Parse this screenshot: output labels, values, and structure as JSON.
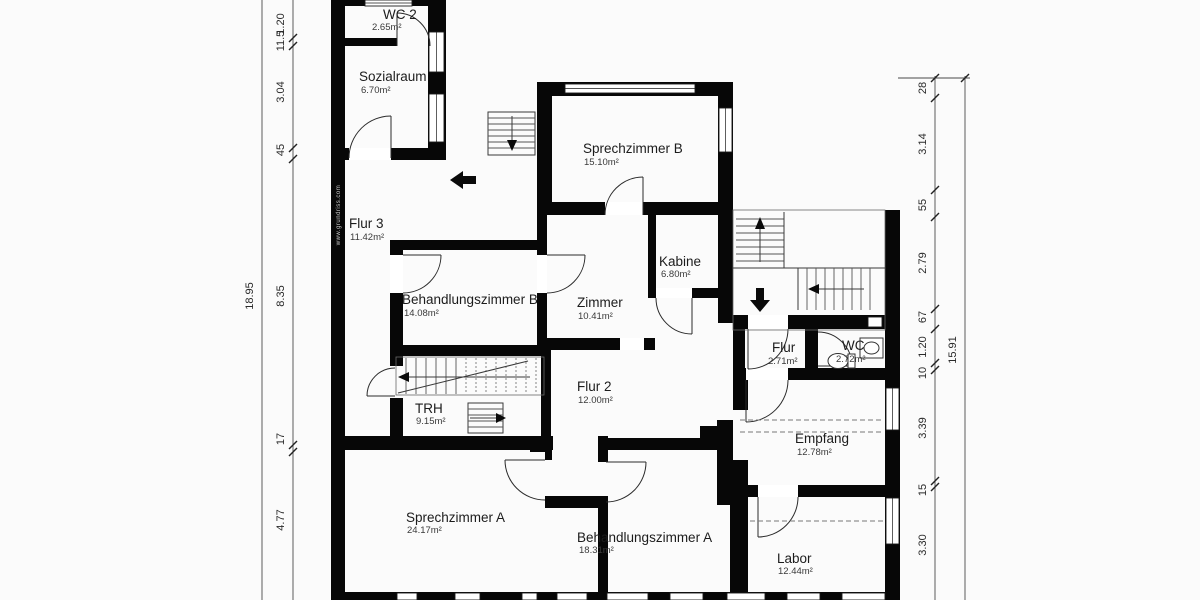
{
  "watermark": "www.grundriss.com",
  "rooms": [
    {
      "id": "wc2",
      "name": "WC 2",
      "area": "2.65m²"
    },
    {
      "id": "sozialraum",
      "name": "Sozialraum",
      "area": "6.70m²"
    },
    {
      "id": "sprechzimmer-b",
      "name": "Sprechzimmer B",
      "area": "15.10m²"
    },
    {
      "id": "flur-3",
      "name": "Flur 3",
      "area": "11.42m²"
    },
    {
      "id": "behandlungszimmer-b",
      "name": "Behandlungszimmer B",
      "area": "14.08m²"
    },
    {
      "id": "zimmer",
      "name": "Zimmer",
      "area": "10.41m²"
    },
    {
      "id": "kabine",
      "name": "Kabine",
      "area": "6.80m²"
    },
    {
      "id": "flur",
      "name": "Flur",
      "area": "2.71m²"
    },
    {
      "id": "wc",
      "name": "WC",
      "area": "2.72m²"
    },
    {
      "id": "flur-2",
      "name": "Flur 2",
      "area": "12.00m²"
    },
    {
      "id": "trh",
      "name": "TRH",
      "area": "9.15m²"
    },
    {
      "id": "empfang",
      "name": "Empfang",
      "area": "12.78m²"
    },
    {
      "id": "sprechzimmer-a",
      "name": "Sprechzimmer A",
      "area": "24.17m²"
    },
    {
      "id": "behandlungszimmer-a",
      "name": "Behandlungszimmer A",
      "area": "18.31m²"
    },
    {
      "id": "labor",
      "name": "Labor",
      "area": "12.44m²"
    }
  ],
  "dimensions": {
    "left_outer": "18.95",
    "left_inner": [
      "1.20",
      "11.5",
      "3.04",
      "45",
      "8.35",
      "17",
      "4.77"
    ],
    "right_inner": [
      "28",
      "3.14",
      "55",
      "2.79",
      "67",
      "1.20",
      "10",
      "3.39",
      "15",
      "3.30"
    ],
    "right_outer": "15.91"
  },
  "colors": {
    "wall": "#000000",
    "dimension_line": "#4a4a4a",
    "room_text": "#1c1c1c",
    "background": "#fbfbfb"
  }
}
